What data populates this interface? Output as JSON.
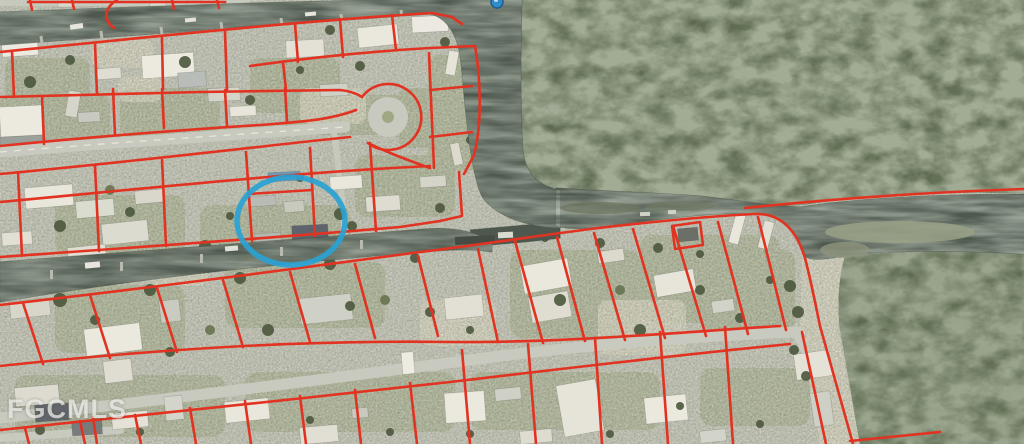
{
  "map": {
    "watermark": "FGCMLS",
    "parcel_overlay": {
      "line_color": "#E23322"
    },
    "highlight_ellipse": {
      "shape": "ellipse",
      "color": "#2AA2D4"
    },
    "pin": {
      "icon": "map-pin-icon",
      "fill": "#2F8CC8",
      "border": "#1B5E8E"
    },
    "terrain": {
      "ground": "#C5C6B8",
      "forest": "#57604A",
      "water": "#4E584E",
      "road": "#C8CABF",
      "sand": "#D8D4C1",
      "lawn": "#A4AC86"
    }
  }
}
